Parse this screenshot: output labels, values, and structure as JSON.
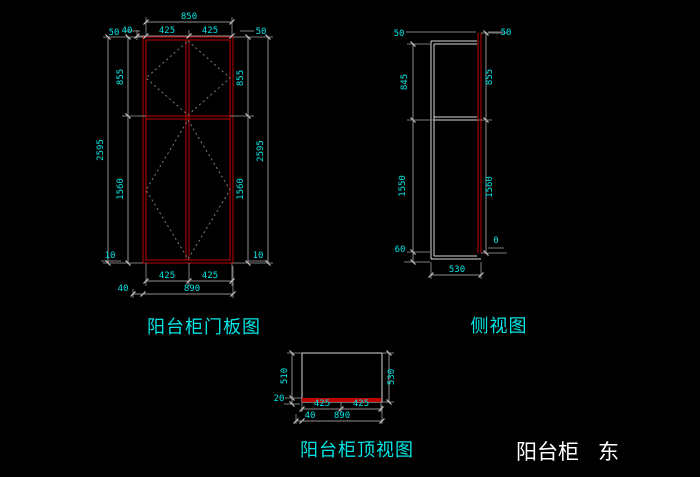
{
  "title": {
    "main": "阳台柜",
    "suffix": "东"
  },
  "colors": {
    "background": "#000000",
    "line_red": "#c00000",
    "line_body": "#d9d9d9",
    "line_dim": "#8f8f8f",
    "line_dash": "#7d7d7d",
    "text_cyan": "#00e5e5",
    "text_white": "#ffffff"
  },
  "views": {
    "door_panel": {
      "label": "阳台柜门板图",
      "dims": {
        "top_total": "850",
        "top_offset": "40",
        "top_half_l": "425",
        "top_half_r": "425",
        "left_gap_top": "50",
        "left_upper": "855",
        "left_total": "2595",
        "left_lower": "1560",
        "left_gap_bottom": "10",
        "right_gap_top": "50",
        "right_upper": "855",
        "right_total": "2595",
        "right_lower": "1560",
        "right_gap_bottom": "10",
        "bottom_half_l": "425",
        "bottom_half_r": "425",
        "bottom_offset": "40",
        "bottom_total": "890"
      }
    },
    "side_view": {
      "label": "侧视图",
      "dims": {
        "gap_top_left": "50",
        "gap_top_right": "50",
        "left_upper": "845",
        "left_lower": "1550",
        "left_bottom": "60",
        "right_upper": "855",
        "right_lower": "1560",
        "right_bottom": "0",
        "bottom_total": "530"
      }
    },
    "top_view": {
      "label": "阳台柜顶视图",
      "dims": {
        "left_depth": "510",
        "left_front": "20",
        "right_depth": "530",
        "bottom_half_l": "425",
        "bottom_half_r": "425",
        "bottom_offset": "40",
        "bottom_total": "890"
      }
    }
  }
}
